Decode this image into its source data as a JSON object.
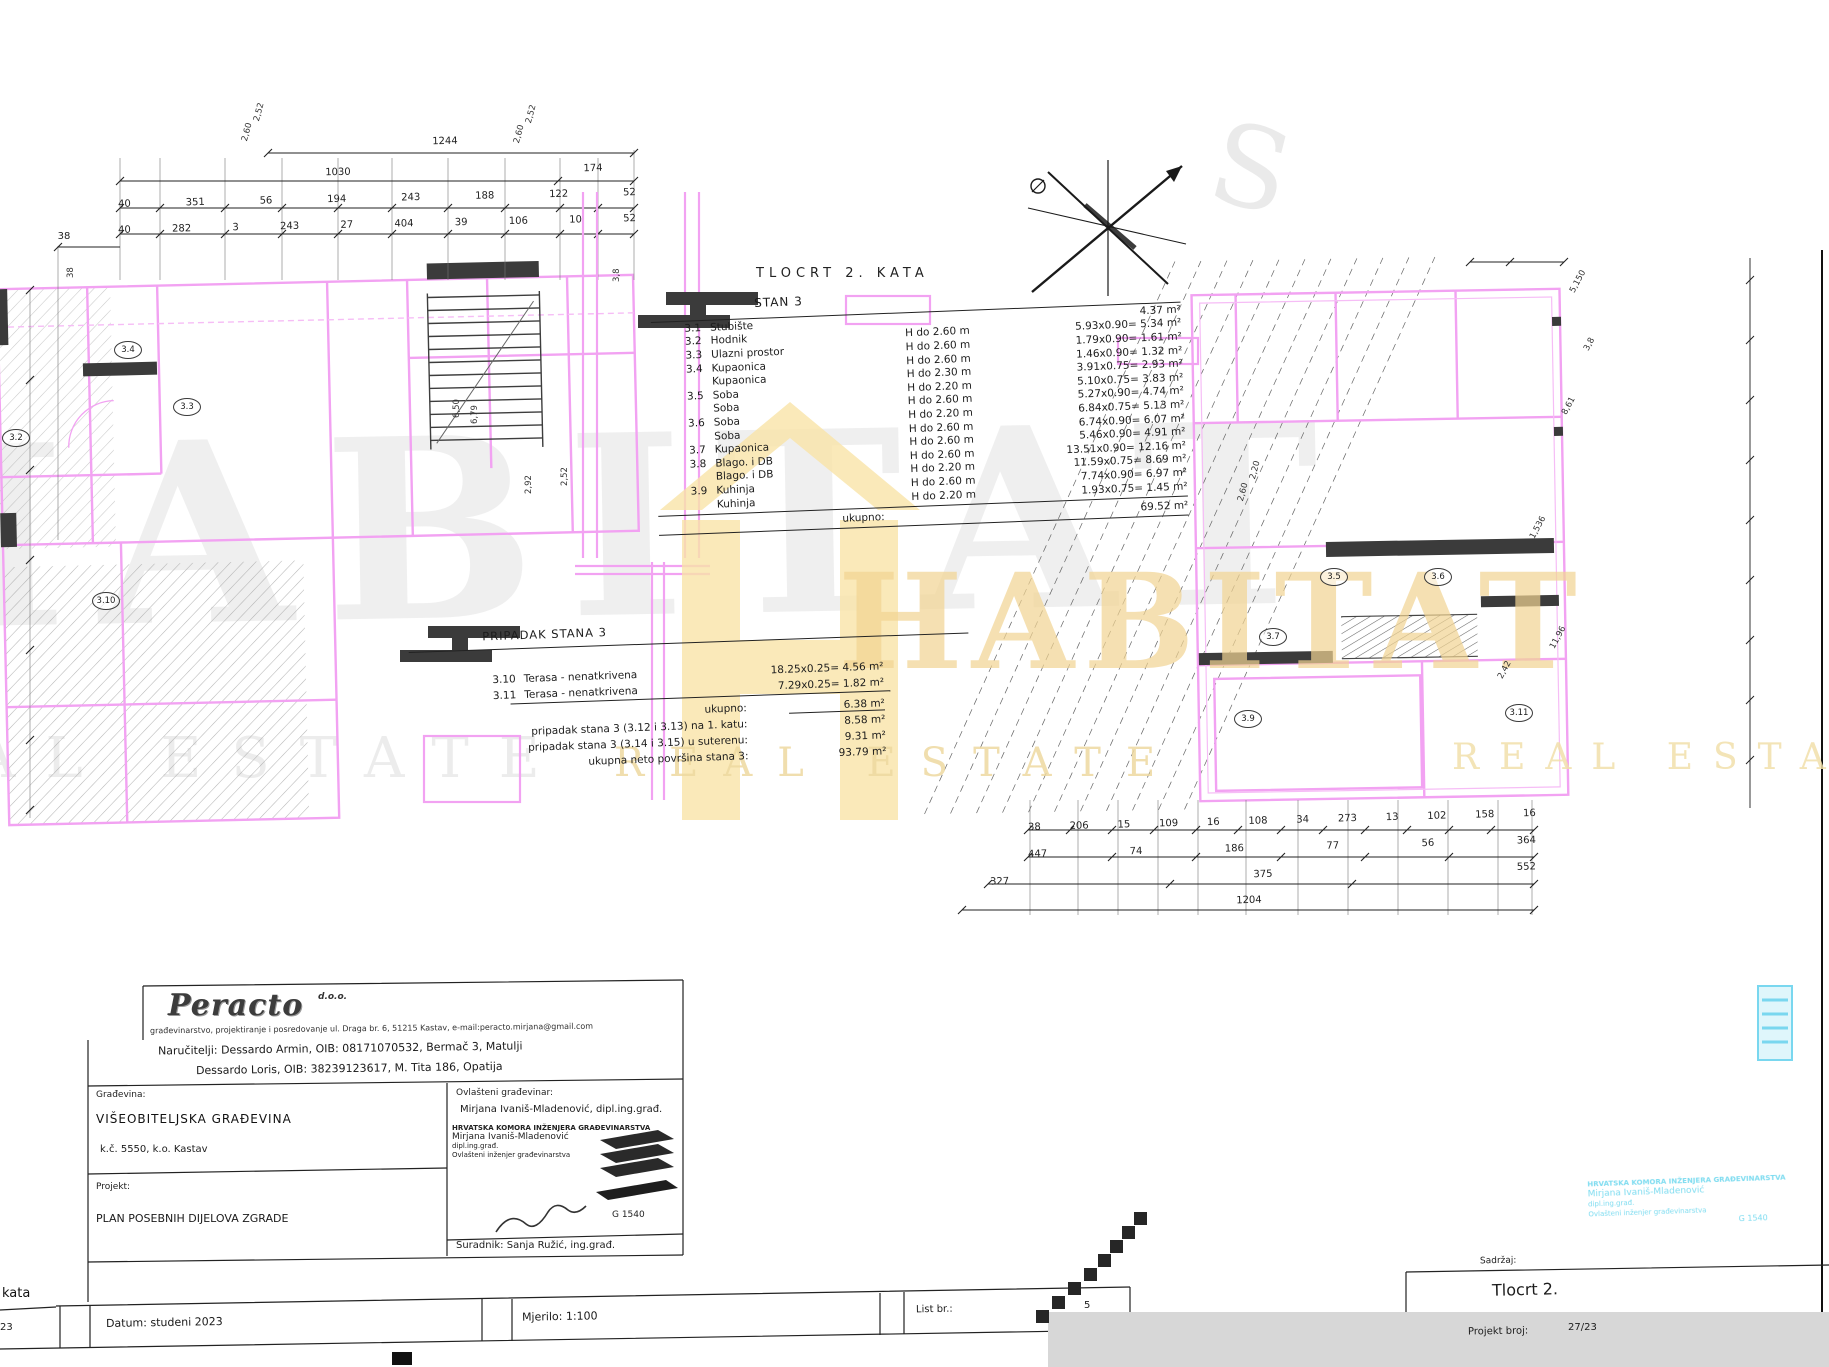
{
  "sheet": {
    "plan_title": "TLOCRT 2. KATA"
  },
  "watermark": {
    "brand": "HABITAT",
    "tagline": "REAL ESTATE",
    "letter": "S"
  },
  "stan3": {
    "heading": "STAN 3",
    "rows": [
      {
        "id": "3.1",
        "name": "Stubište",
        "height": "",
        "calc": "4.37 m²"
      },
      {
        "id": "3.2",
        "name": "Hodnik",
        "height": "H do 2.60 m",
        "calc": "5.93x0.90= 5.34 m²"
      },
      {
        "id": "3.3",
        "name": "Ulazni prostor",
        "height": "H do 2.60 m",
        "calc": "1.79x0.90= 1.61 m²"
      },
      {
        "id": "3.4",
        "name": "Kupaonica",
        "height": "H do 2.60 m",
        "calc": "1.46x0.90= 1.32 m²"
      },
      {
        "id": "",
        "name": "Kupaonica",
        "height": "H do 2.30 m",
        "calc": "3.91x0.75= 2.93 m²"
      },
      {
        "id": "3.5",
        "name": "Soba",
        "height": "H do 2.20 m",
        "calc": "5.10x0.75= 3.83 m²"
      },
      {
        "id": "",
        "name": "Soba",
        "height": "H do 2.60 m",
        "calc": "5.27x0.90= 4.74 m²"
      },
      {
        "id": "3.6",
        "name": "Soba",
        "height": "H do 2.20 m",
        "calc": "6.84x0.75= 5.13 m²"
      },
      {
        "id": "",
        "name": "Soba",
        "height": "H do 2.60 m",
        "calc": "6.74x0.90= 6.07 m²"
      },
      {
        "id": "3.7",
        "name": "Kupaonica",
        "height": "H do 2.60 m",
        "calc": "5.46x0.90= 4.91 m²"
      },
      {
        "id": "3.8",
        "name": "Blago. i DB",
        "height": "H do 2.60 m",
        "calc": "13.51x0.90= 12.16 m²"
      },
      {
        "id": "",
        "name": "Blago. i DB",
        "height": "H do 2.20 m",
        "calc": "11.59x0.75= 8.69 m²"
      },
      {
        "id": "3.9",
        "name": "Kuhinja",
        "height": "H do 2.60 m",
        "calc": "7.74x0.90= 6.97 m²"
      },
      {
        "id": "",
        "name": "Kuhinja",
        "height": "H do 2.20 m",
        "calc": "1.93x0.75= 1.45 m²"
      }
    ],
    "total_label": "ukupno:",
    "total_value": "69.52 m²"
  },
  "pripadak": {
    "heading": "PRIPADAK STANA 3",
    "rows": [
      {
        "id": "3.10",
        "name": "Terasa - nenatkrivena",
        "calc": "18.25x0.25= 4.56 m²"
      },
      {
        "id": "3.11",
        "name": "Terasa - nenatkrivena",
        "calc": "7.29x0.25= 1.82 m²"
      }
    ],
    "total_label": "ukupno:",
    "total_value": "6.38 m²",
    "summary": [
      {
        "label": "pripadak stana 3 (3.12 i 3.13) na 1. katu:",
        "value": "8.58 m²"
      },
      {
        "label": "pripadak stana 3 (3.14 i 3.15) u suterenu:",
        "value": "9.31 m²"
      },
      {
        "label": "ukupna neto površina stana 3:",
        "value": "93.79 m²"
      }
    ]
  },
  "dims": {
    "left_total": "1244",
    "left_row2": [
      "1030",
      "174"
    ],
    "left_row3": [
      "40",
      "351",
      "56",
      "194",
      "243",
      "188",
      "122",
      "52"
    ],
    "left_row4": [
      "40",
      "282",
      "3",
      "243",
      "27",
      "404",
      "39",
      "106",
      "10",
      "52"
    ],
    "left_corner": "38",
    "left_side": [
      "38",
      "3,8",
      "2,52",
      "6,50",
      "6,79",
      "2,92"
    ],
    "right_row1": [
      "38",
      "206",
      "15",
      "109",
      "16",
      "108",
      "34",
      "273",
      "13",
      "102",
      "158",
      "16"
    ],
    "right_row2": [
      "447",
      "74",
      "186",
      "77",
      "56",
      "364"
    ],
    "right_row3": [
      "327",
      "375",
      "552"
    ],
    "right_total": "1204",
    "right_side": [
      "5,150",
      "3,8",
      "8,61",
      "1,536",
      "11,96",
      "2,42"
    ],
    "rot_top_a": "2,60",
    "rot_top_b": "2,52",
    "rot_plan_a": "2,60",
    "rot_plan_b": "2,20"
  },
  "rooms": {
    "left": [
      "3.4",
      "3.3",
      "3.2",
      "3.10"
    ],
    "right": [
      "3.5",
      "3.6",
      "3.7",
      "3.9",
      "3.11"
    ]
  },
  "titleblock": {
    "company": "Peracto",
    "company_suffix": "d.o.o.",
    "company_line": "građevinarstvo, projektiranje i posredovanje   ul. Draga br. 6, 51215 Kastav, e-mail:peracto.mirjana@gmail.com",
    "client_1": "Naručitelji: Dessardo Armin, OIB: 08171070532, Bermač 3, Matulji",
    "client_2": "Dessardo Loris, OIB: 38239123617, M. Tita 186, Opatija",
    "building_label": "Građevina:",
    "building": "VIŠEOBITELJSKA GRAĐEVINA",
    "parcel": "k.č. 5550, k.o. Kastav",
    "project_label": "Projekt:",
    "project": "PLAN POSEBNIH DIJELOVA ZGRADE",
    "engineer_label": "Ovlašteni građevinar:",
    "engineer": "Mirjana Ivaniš-Mladenović, dipl.ing.građ.",
    "collaborator": "Suradnik: Sanja Ružić, ing.građ.",
    "date": "Datum: studeni 2023",
    "scale": "Mjerilo: 1:100",
    "sheet_label": "List br.:",
    "sheet_no": "5",
    "corner_text": "kata",
    "corner_no": "23",
    "content_label": "Sadržaj:",
    "content": "Tlocrt 2.",
    "project_no_label": "Projekt broj:",
    "project_no": "27/23"
  },
  "stamp": {
    "chamber": "HRVATSKA KOMORA INŽENJERA GRAĐEVINARSTVA",
    "name": "Mirjana Ivaniš-Mladenović",
    "title": "dipl.ing.građ.",
    "role": "Ovlašteni inženjer građevinarstva",
    "number": "G 1540"
  },
  "colors": {
    "wall_magenta": "#f2a2f2",
    "watermark_yellow": "#f2d492",
    "stamp_cyan": "#7edcf0",
    "ink": "#1c1c1c"
  }
}
